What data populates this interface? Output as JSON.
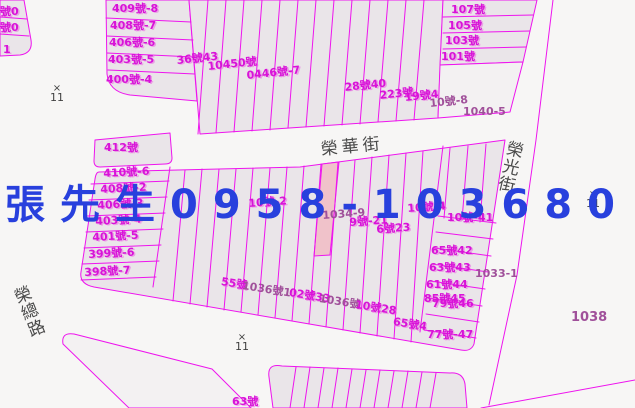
{
  "colors": {
    "background": "#f7f6f5",
    "parcel_fill": "#eae5e9",
    "parcel_fill_pale": "#f3f1f2",
    "boundary_magenta": "#ee14ee",
    "highlight_fill": "#f0c2ca",
    "label_magenta": "#d813d8",
    "label_purple": "#a0509a",
    "street_text": "#4a4a4a",
    "watermark_blue": "#2840dd",
    "marker_gray": "#3f3f3f"
  },
  "watermark": {
    "text": "張先生0958-103680"
  },
  "streets": {
    "ronghua": "榮華街",
    "rongguang": "榮光街",
    "rongzong": "榮總路"
  },
  "markers": [
    {
      "symbol": "×",
      "number": "11",
      "x": 48,
      "y": 84
    },
    {
      "symbol": "×",
      "number": "11",
      "x": 584,
      "y": 190
    },
    {
      "symbol": "×",
      "number": "11",
      "x": 233,
      "y": 333
    }
  ],
  "parcel_labels": [
    {
      "t": "號0",
      "x": 0,
      "y": 6
    },
    {
      "t": "號0",
      "x": 0,
      "y": 22
    },
    {
      "t": "1",
      "x": 3,
      "y": 44
    },
    {
      "t": "409號-8",
      "x": 112,
      "y": 3
    },
    {
      "t": "408號-7",
      "x": 110,
      "y": 20
    },
    {
      "t": "406號-6",
      "x": 109,
      "y": 37
    },
    {
      "t": "403號-5",
      "x": 108,
      "y": 54
    },
    {
      "t": "400號-4",
      "x": 106,
      "y": 74
    },
    {
      "t": "36號43",
      "x": 176,
      "y": 55,
      "r": -6
    },
    {
      "t": "10450號",
      "x": 207,
      "y": 61,
      "r": -6
    },
    {
      "t": "0446號-7",
      "x": 246,
      "y": 70,
      "r": -6
    },
    {
      "t": "28號40",
      "x": 344,
      "y": 82,
      "r": -6
    },
    {
      "t": "223號",
      "x": 379,
      "y": 90,
      "r": -6
    },
    {
      "t": "19號4",
      "x": 404,
      "y": 92,
      "r": -6
    },
    {
      "t": "10號-8",
      "x": 429,
      "y": 98,
      "c": "p",
      "r": -6
    },
    {
      "t": "107號",
      "x": 451,
      "y": 4
    },
    {
      "t": "105號",
      "x": 448,
      "y": 20
    },
    {
      "t": "103號",
      "x": 445,
      "y": 35
    },
    {
      "t": "101號",
      "x": 441,
      "y": 51
    },
    {
      "t": "1040-5",
      "x": 463,
      "y": 106,
      "c": "p"
    },
    {
      "t": "412號",
      "x": 104,
      "y": 142
    },
    {
      "t": "410號-6",
      "x": 103,
      "y": 168,
      "r": -3
    },
    {
      "t": "408號-2",
      "x": 100,
      "y": 184,
      "r": -3
    },
    {
      "t": "406號-3",
      "x": 97,
      "y": 200,
      "r": -3
    },
    {
      "t": "403號-4",
      "x": 95,
      "y": 216,
      "r": -3
    },
    {
      "t": "401號-5",
      "x": 92,
      "y": 232,
      "r": -3
    },
    {
      "t": "399號-6",
      "x": 88,
      "y": 249,
      "r": -3
    },
    {
      "t": "398號-7",
      "x": 84,
      "y": 267,
      "r": -3
    },
    {
      "t": "10號-2",
      "x": 248,
      "y": 198,
      "r": -4
    },
    {
      "t": "1034-9",
      "x": 322,
      "y": 210,
      "c": "p",
      "r": -4
    },
    {
      "t": "9號-21",
      "x": 349,
      "y": 217,
      "r": -4
    },
    {
      "t": "6號23",
      "x": 376,
      "y": 224,
      "r": -4
    },
    {
      "t": "10號-4",
      "x": 407,
      "y": 203,
      "r": -4
    },
    {
      "t": "10號-41",
      "x": 447,
      "y": 212
    },
    {
      "t": "65號42",
      "x": 431,
      "y": 245
    },
    {
      "t": "63號43",
      "x": 429,
      "y": 262
    },
    {
      "t": "1033-1",
      "x": 475,
      "y": 268,
      "c": "p"
    },
    {
      "t": "61號44",
      "x": 426,
      "y": 279
    },
    {
      "t": "85號45",
      "x": 424,
      "y": 293
    },
    {
      "t": "79號46",
      "x": 432,
      "y": 298
    },
    {
      "t": "77號-47",
      "x": 427,
      "y": 329
    },
    {
      "t": "55號",
      "x": 222,
      "y": 276,
      "r": 9
    },
    {
      "t": "1036號1",
      "x": 243,
      "y": 280,
      "c": "p",
      "r": 9
    },
    {
      "t": "02號33",
      "x": 290,
      "y": 287,
      "r": 9
    },
    {
      "t": "1036號",
      "x": 320,
      "y": 293,
      "c": "p",
      "r": 9
    },
    {
      "t": "10號28",
      "x": 356,
      "y": 299,
      "r": 9
    },
    {
      "t": "65號4",
      "x": 394,
      "y": 316,
      "r": 9
    },
    {
      "t": "1038",
      "x": 571,
      "y": 312,
      "c": "p",
      "s": 13
    },
    {
      "t": "63號",
      "x": 232,
      "y": 396
    }
  ]
}
